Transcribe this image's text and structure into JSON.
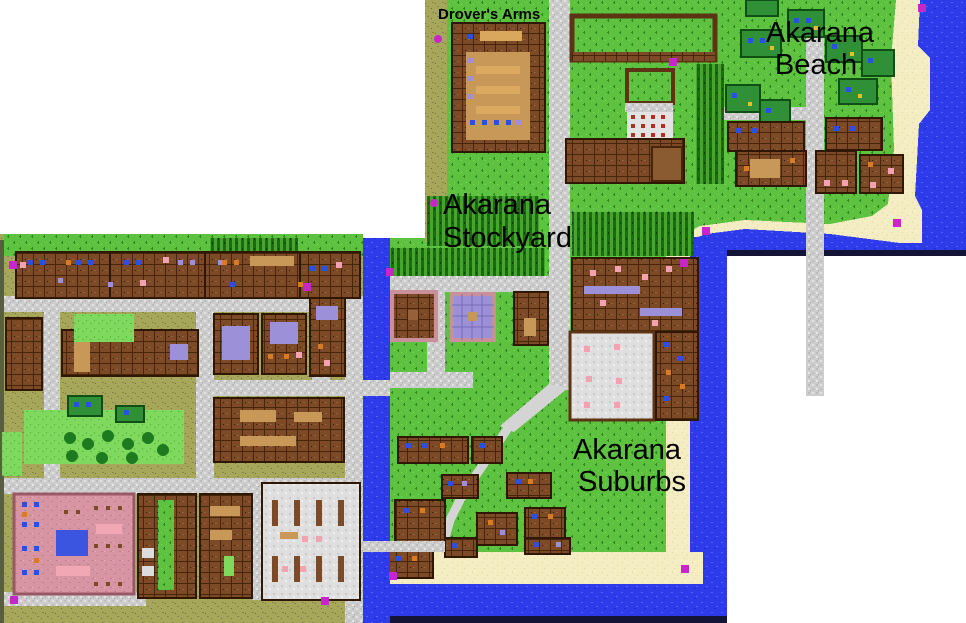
{
  "map_labels": [
    {
      "id": "drovers-arms",
      "lines": [
        "Drover's Arms"
      ]
    },
    {
      "id": "akarana-beach",
      "lines": [
        "Akarana",
        "Beach"
      ]
    },
    {
      "id": "akarana-stockyard",
      "lines": [
        "Akarana",
        "Stockyard"
      ]
    },
    {
      "id": "akarana-suburbs",
      "lines": [
        "Akarana",
        "Suburbs"
      ]
    }
  ],
  "colors": {
    "background": "#ffffff",
    "grass": "#5CC23F",
    "olive_ground": "#A6A75B",
    "road": "#CDCDCD",
    "water": "#2E3BEA",
    "sand": "#F4EDC3",
    "crop_field": "#46A52B",
    "building_brown": "#7C4A26",
    "building_outline": "#2E1703",
    "stall_roof_green": "#2F9038",
    "pink_floor": "#D795A3",
    "lavender": "#9C90D8",
    "tan_floor": "#C89858",
    "pig_pink": "#F2A2B0",
    "marker": "#C826C8",
    "label_text": "#000000",
    "map_edge_line": "#141436"
  },
  "markers": [
    {
      "x": 918,
      "y": 4,
      "shape": "square"
    },
    {
      "x": 434,
      "y": 35,
      "shape": "circle"
    },
    {
      "x": 669,
      "y": 58,
      "shape": "square"
    },
    {
      "x": 430,
      "y": 199,
      "shape": "circle"
    },
    {
      "x": 702,
      "y": 227,
      "shape": "square"
    },
    {
      "x": 680,
      "y": 259,
      "shape": "square"
    },
    {
      "x": 893,
      "y": 219,
      "shape": "square"
    },
    {
      "x": 386,
      "y": 268,
      "shape": "square"
    },
    {
      "x": 303,
      "y": 283,
      "shape": "square"
    },
    {
      "x": 9,
      "y": 261,
      "shape": "square"
    },
    {
      "x": 10,
      "y": 596,
      "shape": "square"
    },
    {
      "x": 321,
      "y": 597,
      "shape": "square"
    },
    {
      "x": 389,
      "y": 572,
      "shape": "square"
    },
    {
      "x": 681,
      "y": 565,
      "shape": "square"
    }
  ]
}
